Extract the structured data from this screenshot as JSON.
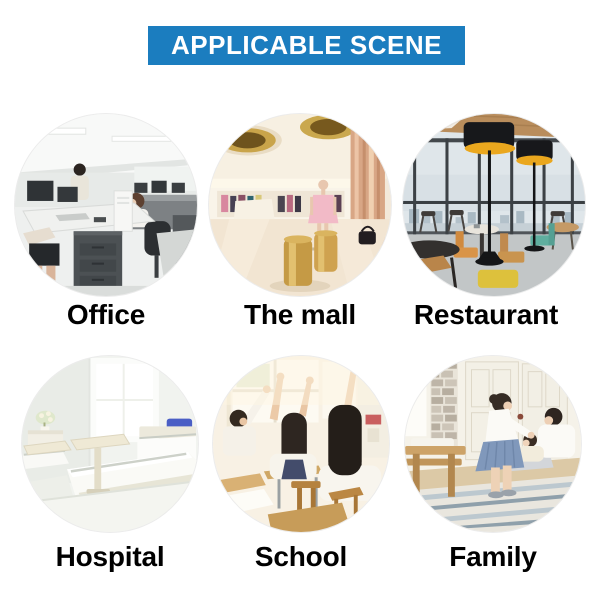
{
  "header": {
    "title": "APPLICABLE SCENE"
  },
  "scenes": [
    {
      "id": "office",
      "label": "Office",
      "photo": "office-interior-photo"
    },
    {
      "id": "mall",
      "label": "The mall",
      "photo": "shopping-mall-photo"
    },
    {
      "id": "restaurant",
      "label": "Restaurant",
      "photo": "restaurant-interior-photo"
    },
    {
      "id": "hospital",
      "label": "Hospital",
      "photo": "hospital-ward-photo"
    },
    {
      "id": "school",
      "label": "School",
      "photo": "classroom-photo"
    },
    {
      "id": "family",
      "label": "Family",
      "photo": "family-living-room-photo"
    }
  ],
  "colors": {
    "banner_bg": "#1b7dbf",
    "banner_text": "#ffffff",
    "label_text": "#000000",
    "page_bg": "#ffffff"
  }
}
